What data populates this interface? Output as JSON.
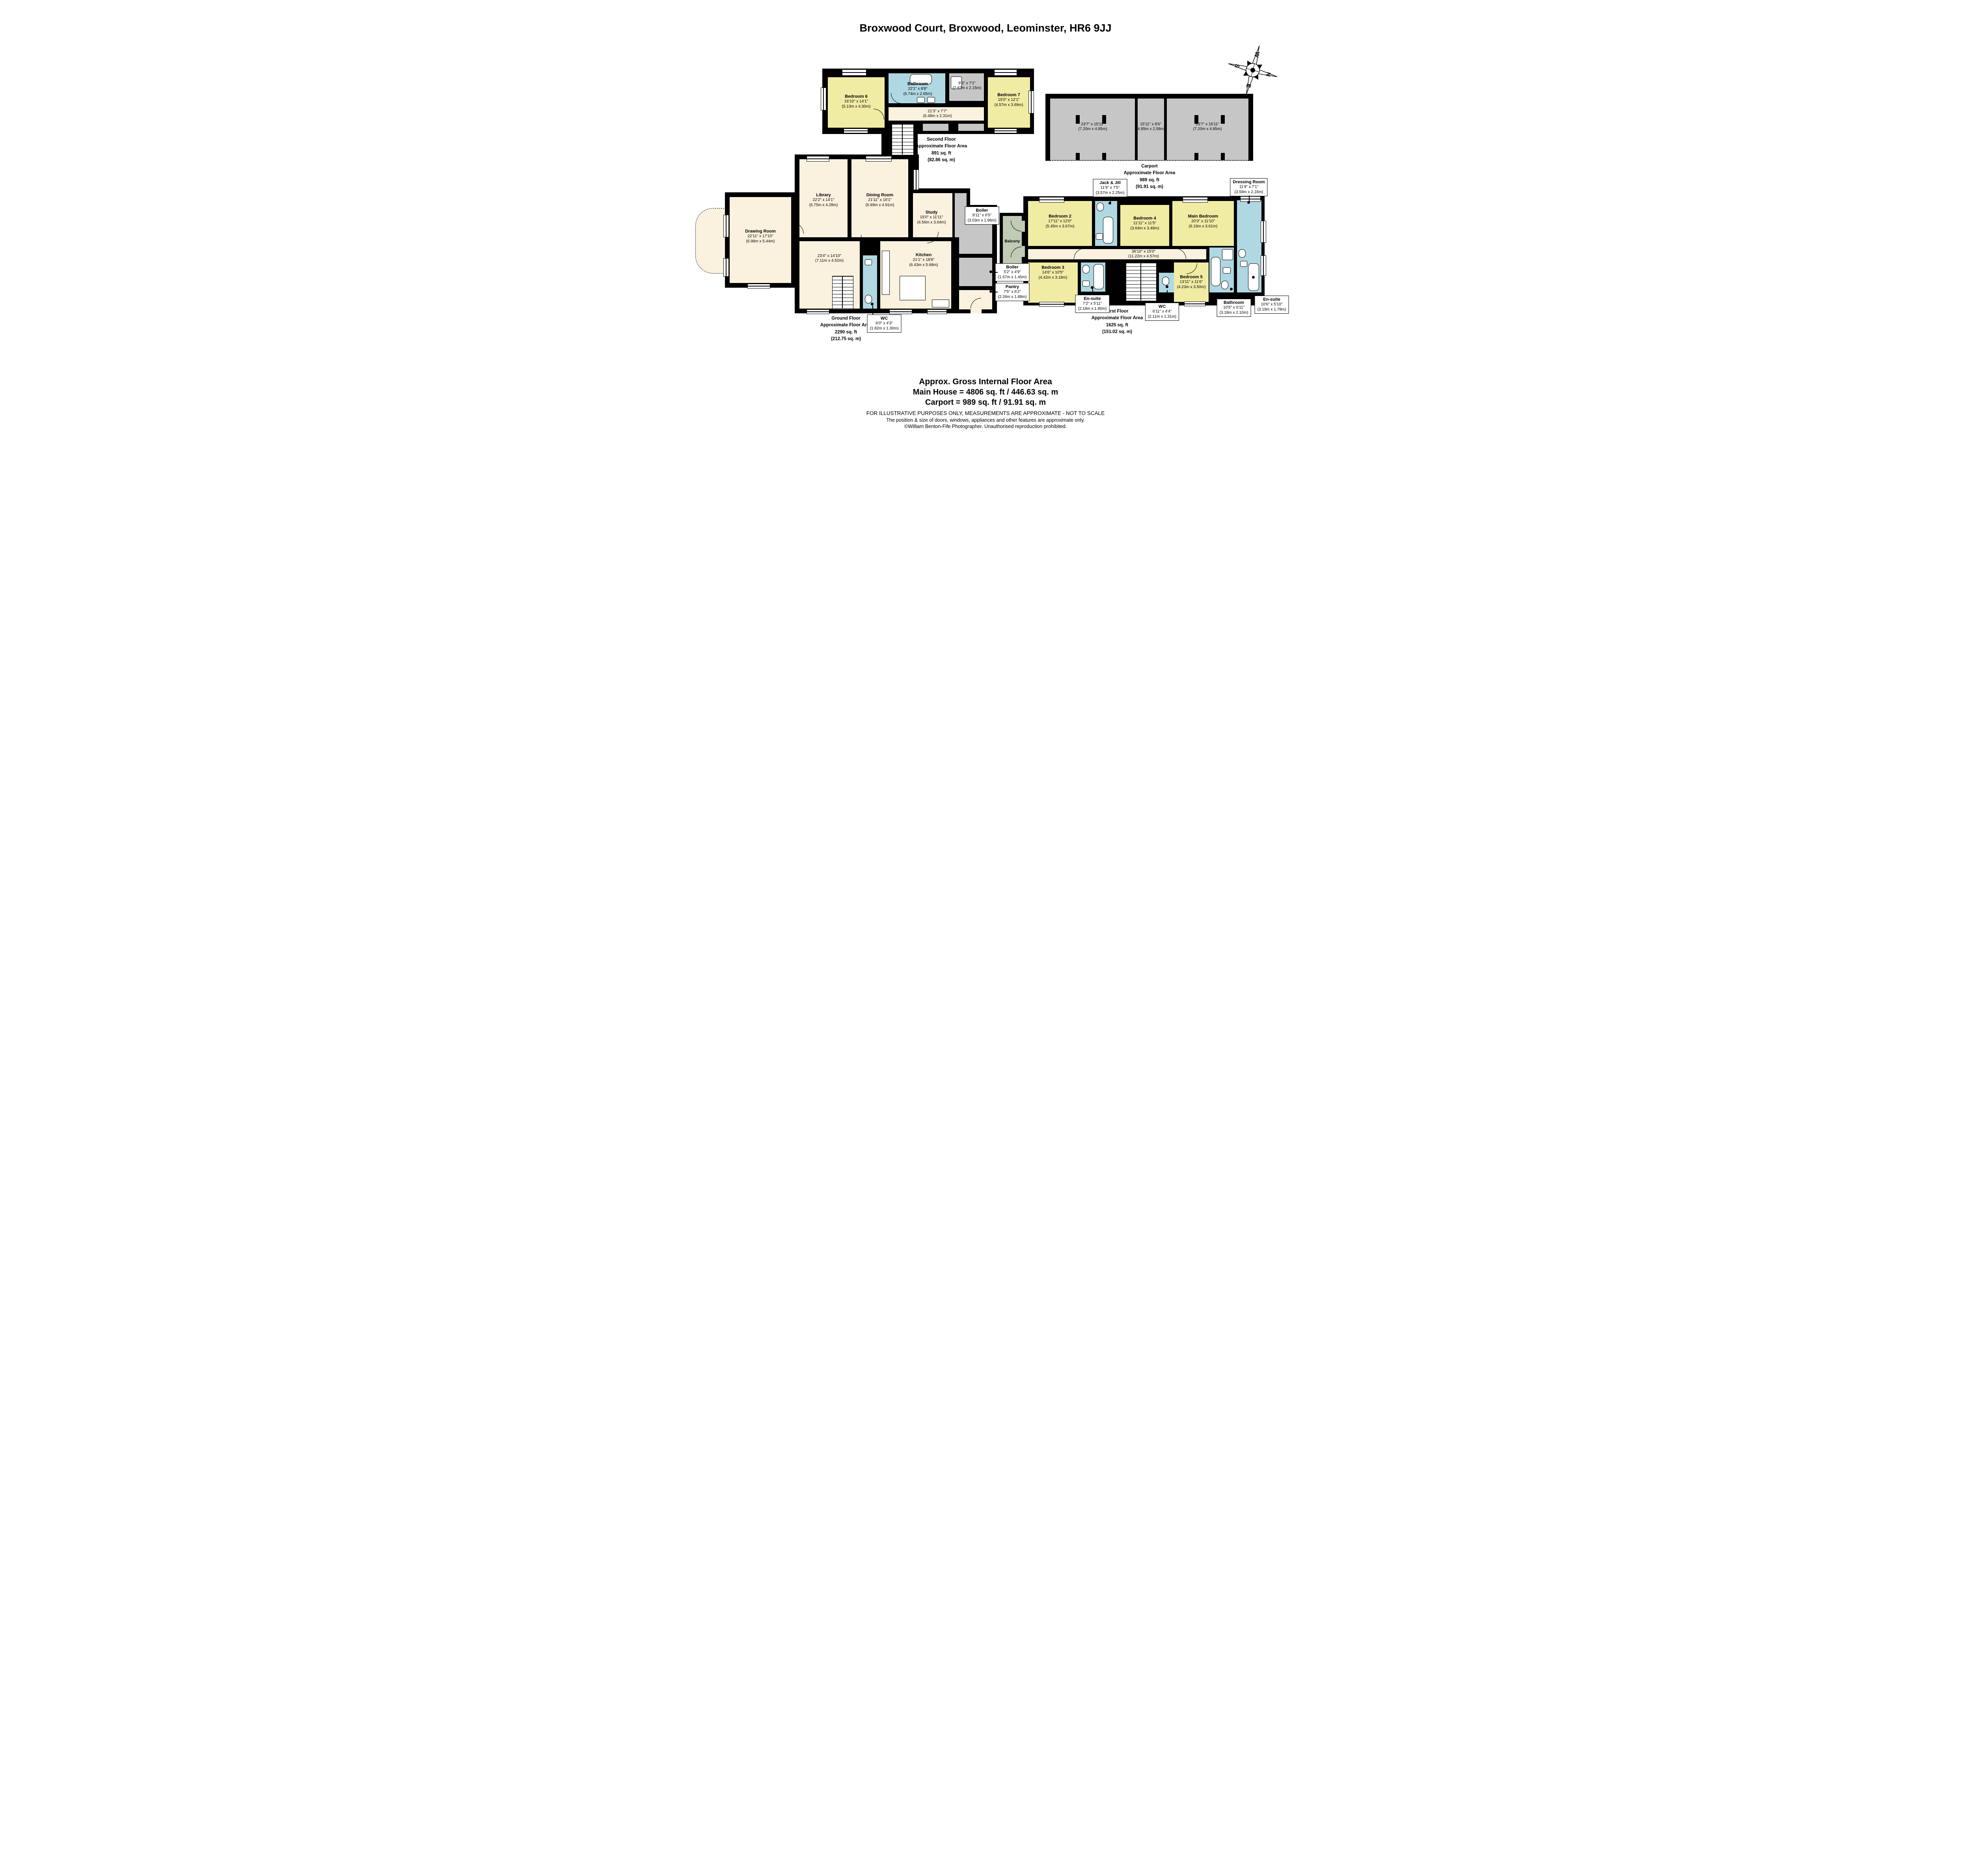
{
  "title": "Broxwood Court, Broxwood, Leominster, HR6 9JJ",
  "compass": {
    "n": "N",
    "e": "E",
    "s": "S",
    "w": "W"
  },
  "colors": {
    "wall": "#000000",
    "bedroom_yellow": "#F1ECA3",
    "bathroom_blue": "#AFD8E2",
    "living_cream": "#FAF2DE",
    "utility_gray": "#C6C6C6",
    "balcony_sage": "#BFCBB5"
  },
  "floors": {
    "second": {
      "caption": [
        "Second Floor",
        "Approximate Floor Area",
        "891 sq. ft",
        "(82.86 sq. m)"
      ],
      "rooms": {
        "bedroom6": {
          "name": "Bedroom 6",
          "dims": "16'10\" x 14'1\"",
          "metric": "(5.13m x 4.30m)"
        },
        "bathroom": {
          "name": "Bathroom",
          "dims": "22'1\" x 8'8\"",
          "metric": "(6.74m x 2.65m)"
        },
        "store": {
          "dims": "9'3\" x 7'1\"",
          "metric": "(2.82m x 2.15m)"
        },
        "bedroom7": {
          "name": "Bedroom 7",
          "dims": "15'0\" x 12'1\"",
          "metric": "(4.57m x 3.69m)"
        },
        "landing": {
          "dims": "21'3\" x 7'7\"",
          "metric": "(6.48m x 2.31m)"
        }
      }
    },
    "carport": {
      "caption": [
        "Carport",
        "Approximate Floor Area",
        "989 sq. ft",
        "(91.91 sq. m)"
      ],
      "rooms": {
        "left_bay": {
          "dims": "23'7\" x 15'11\"",
          "metric": "(7.20m x 4.85m)"
        },
        "middle_bay": {
          "dims": "15'11\" x 8'6\"",
          "metric": "(4.85m x 2.58m)"
        },
        "right_bay": {
          "dims": "23'7\" x 15'11\"",
          "metric": "(7.20m x 4.85m)"
        }
      }
    },
    "ground": {
      "caption": [
        "Ground Floor",
        "Approximate Floor Area",
        "2290 sq. ft",
        "(212.75 sq. m)"
      ],
      "rooms": {
        "drawing": {
          "name": "Drawing Room",
          "dims": "22'11\" x 17'10\"",
          "metric": "(6.98m x 5.44m)"
        },
        "library": {
          "name": "Library",
          "dims": "22'2\" x 14'1\"",
          "metric": "(6.75m x 4.28m)"
        },
        "dining": {
          "name": "Dining Room",
          "dims": "21'11\" x 16'1\"",
          "metric": "(6.69m x 4.91m)"
        },
        "study": {
          "name": "Study",
          "dims": "15'0\" x 11'11\"",
          "metric": "(4.56m x 3.64m)"
        },
        "hall": {
          "dims": "23'4\" x 14'10\"",
          "metric": "(7.11m x 4.52m)"
        },
        "kitchen": {
          "name": "Kitchen",
          "dims": "21'1\" x 18'8\"",
          "metric": "(6.43m x 5.68m)"
        },
        "boiler_large": {
          "name": "Boiler",
          "dims": "9'11\" x 6'5\"",
          "metric": "(3.03m x 1.96m)"
        },
        "boiler_small": {
          "name": "Boiler",
          "dims": "5'2\" x 4'9\"",
          "metric": "(1.57m x 1.45m)"
        },
        "pantry": {
          "name": "Pantry",
          "dims": "7'5\" x 6'2\"",
          "metric": "(2.26m x 1.88m)"
        },
        "wc": {
          "name": "WC",
          "dims": "6'0\" x 4'3\"",
          "metric": "(1.82m x 1.30m)"
        }
      }
    },
    "first": {
      "caption": [
        "First Floor",
        "Approximate Floor Area",
        "1625 sq. ft",
        "(151.02 sq. m)"
      ],
      "rooms": {
        "balcony": {
          "name": "Balcony"
        },
        "bedroom2": {
          "name": "Bedroom 2",
          "dims": "17'11\" x 12'0\"",
          "metric": "(5.45m x 3.67m)"
        },
        "jack_jill": {
          "name": "Jack & Jill",
          "dims": "11'9\" x 7'5\"",
          "metric": "(3.57m x 2.25m)"
        },
        "bedroom4": {
          "name": "Bedroom 4",
          "dims": "11'11\" x 11'5\"",
          "metric": "(3.64m x 3.49m)"
        },
        "main_bedroom": {
          "name": "Main Bedroom",
          "dims": "20'3\" x 11'10\"",
          "metric": "(6.16m x 3.61m)"
        },
        "dressing": {
          "name": "Dressing Room",
          "dims": "11'9\" x 7'1\"",
          "metric": "(3.58m x 2.16m)"
        },
        "landing": {
          "dims": "36'10\" x 15'0\"",
          "metric": "(11.22m x 4.57m)"
        },
        "bedroom3": {
          "name": "Bedroom 3",
          "dims": "14'6\" x 10'5\"",
          "metric": "(4.42m x 3.18m)"
        },
        "ensuite3": {
          "name": "En-suite",
          "dims": "7'2\" x 5'11\"",
          "metric": "(2.18m x 1.80m)"
        },
        "bedroom5": {
          "name": "Bedroom 5",
          "dims": "13'11\" x 11'6\"",
          "metric": "(4.23m x 3.50m)"
        },
        "bathroom": {
          "name": "Bathroom",
          "dims": "10'5\" x 6'11\"",
          "metric": "(3.18m x 2.10m)"
        },
        "ensuite_main": {
          "name": "En-suite",
          "dims": "10'6\" x 5'10\"",
          "metric": "(3.19m x 1.79m)"
        },
        "wc": {
          "name": "WC",
          "dims": "6'11\" x 4'4\"",
          "metric": "(2.11m x 1.31m)"
        }
      }
    }
  },
  "summary": {
    "heading": "Approx. Gross Internal Floor Area",
    "main_house": "Main House = 4806 sq. ft / 446.63 sq. m",
    "carport": "Carport = 989 sq. ft / 91.91 sq. m",
    "disclaimer1": "FOR ILLUSTRATIVE PURPOSES ONLY, MEASUREMENTS ARE APPROXIMATE - NOT TO SCALE",
    "disclaimer2": "The position & size of doors, windows, appliances and other features are approximate only.",
    "copyright": "©William Benton-Fife Photographer. Unauthorised reproduction prohibited."
  }
}
